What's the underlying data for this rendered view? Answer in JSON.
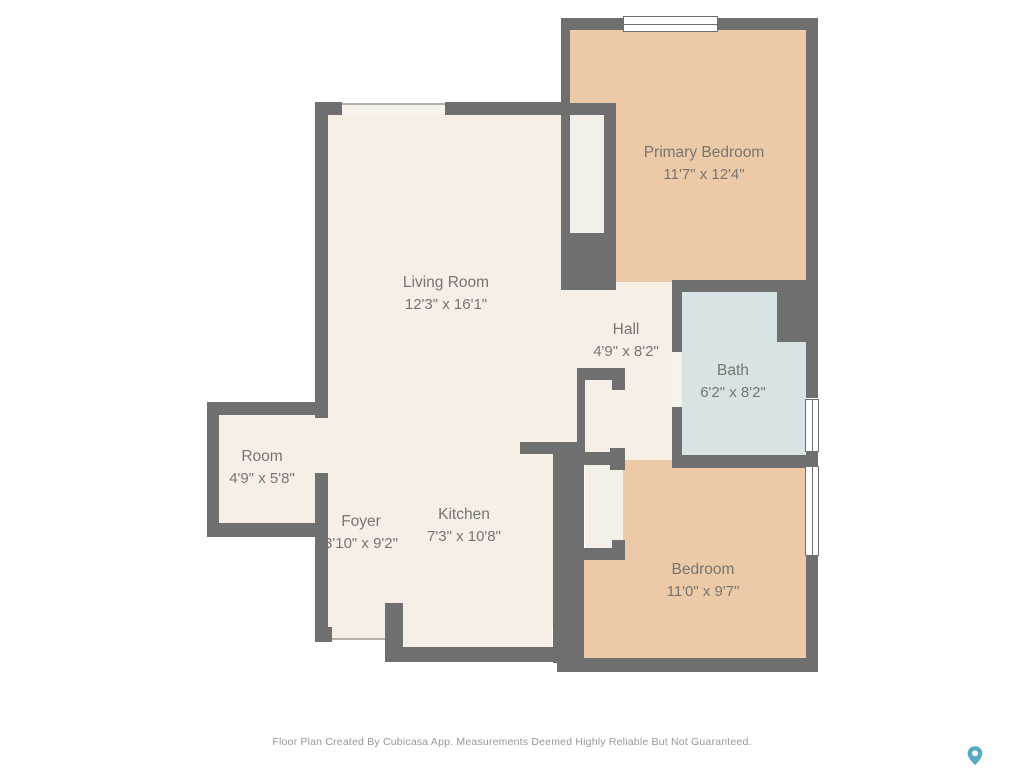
{
  "plan": {
    "type": "floor-plan",
    "rooms": [
      {
        "name": "Primary Bedroom",
        "dims": "11'7\" x 12'4\""
      },
      {
        "name": "Living Room",
        "dims": "12'3\" x 16'1\""
      },
      {
        "name": "Hall",
        "dims": "4'9\" x 8'2\""
      },
      {
        "name": "Bath",
        "dims": "6'2\" x 8'2\""
      },
      {
        "name": "Room",
        "dims": "4'9\" x 5'8\""
      },
      {
        "name": "Foyer",
        "dims": "3'10\" x 9'2\""
      },
      {
        "name": "Kitchen",
        "dims": "7'3\" x 10'8\""
      },
      {
        "name": "Bedroom",
        "dims": "11'0\" x 9'7\""
      }
    ],
    "colors": {
      "wall": "#6f6f6f",
      "floor_main": "#f5efe6",
      "floor_bedrooms": "#edcaa7",
      "floor_bath": "#d7e3e4",
      "label_text": "#787571",
      "footer_text": "#989898",
      "logo_pin": "#57aac6"
    }
  },
  "footer": {
    "disclaimer": "Floor Plan Created By Cubicasa App. Measurements Deemed Highly Reliable But Not Guaranteed."
  },
  "logo": {
    "icon": "map-pin-icon"
  }
}
